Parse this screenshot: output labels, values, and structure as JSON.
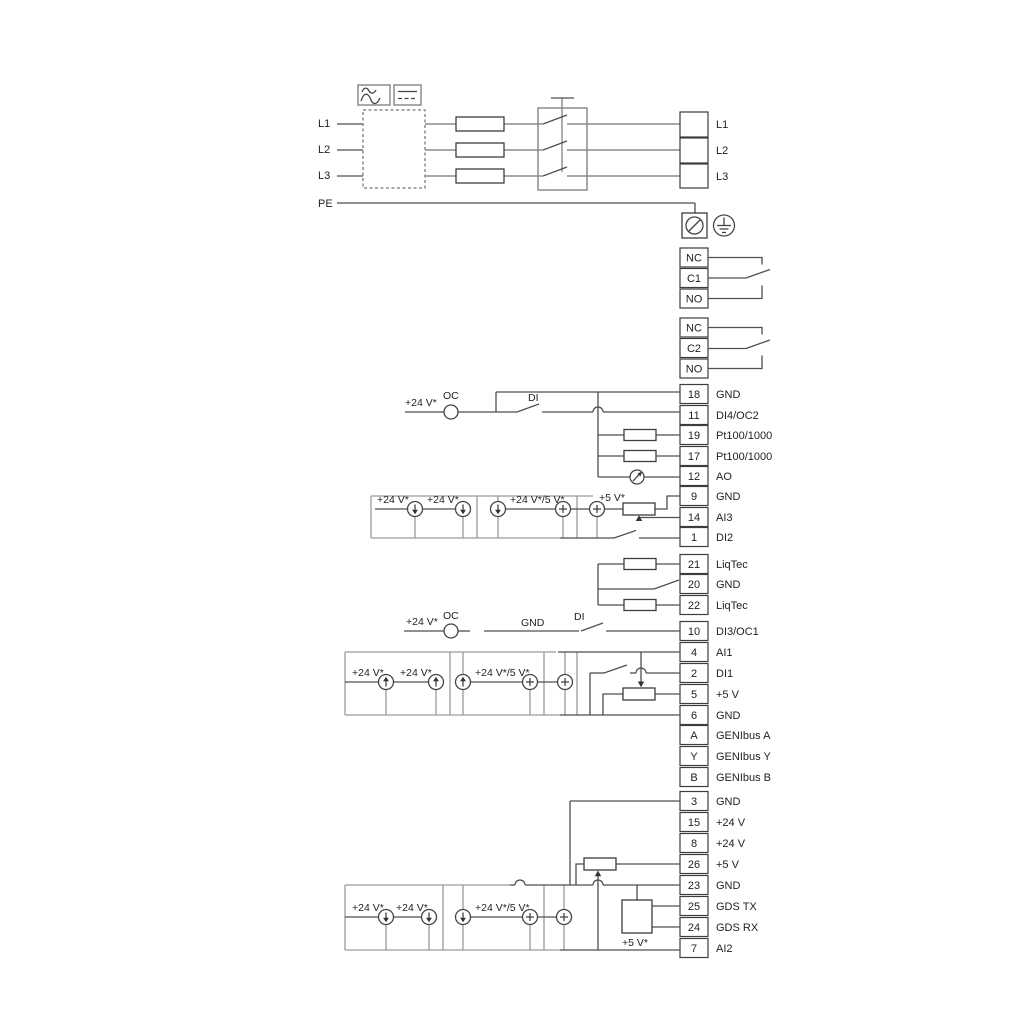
{
  "power": {
    "in": [
      "L1",
      "L2",
      "L3",
      "PE"
    ],
    "out": [
      "L1",
      "L2",
      "L3"
    ]
  },
  "relay1": [
    "NC",
    "C1",
    "NO"
  ],
  "relay2": [
    "NC",
    "C2",
    "NO"
  ],
  "terminals": [
    {
      "num": "18",
      "label": "GND"
    },
    {
      "num": "11",
      "label": "DI4/OC2"
    },
    {
      "num": "19",
      "label": "Pt100/1000"
    },
    {
      "num": "17",
      "label": "Pt100/1000"
    },
    {
      "num": "12",
      "label": "AO"
    },
    {
      "num": "9",
      "label": "GND"
    },
    {
      "num": "14",
      "label": "AI3"
    },
    {
      "num": "1",
      "label": "DI2"
    },
    {
      "num": "21",
      "label": "LiqTec"
    },
    {
      "num": "20",
      "label": "GND"
    },
    {
      "num": "22",
      "label": "LiqTec"
    },
    {
      "num": "10",
      "label": "DI3/OC1"
    },
    {
      "num": "4",
      "label": "AI1"
    },
    {
      "num": "2",
      "label": "DI1"
    },
    {
      "num": "5",
      "label": "+5 V"
    },
    {
      "num": "6",
      "label": "GND"
    },
    {
      "num": "A",
      "label": "GENIbus A"
    },
    {
      "num": "Y",
      "label": "GENIbus Y"
    },
    {
      "num": "B",
      "label": "GENIbus B"
    },
    {
      "num": "3",
      "label": "GND"
    },
    {
      "num": "15",
      "label": "+24 V"
    },
    {
      "num": "8",
      "label": "+24 V"
    },
    {
      "num": "26",
      "label": "+5 V"
    },
    {
      "num": "23",
      "label": "GND"
    },
    {
      "num": "25",
      "label": "GDS TX"
    },
    {
      "num": "24",
      "label": "GDS RX"
    },
    {
      "num": "7",
      "label": "AI2"
    }
  ],
  "labels": {
    "v24": "+24 V*",
    "v24v5": "+24 V*/5 V*",
    "v5": "+5 V*",
    "oc": "OC",
    "di": "DI",
    "gnd": "GND"
  }
}
